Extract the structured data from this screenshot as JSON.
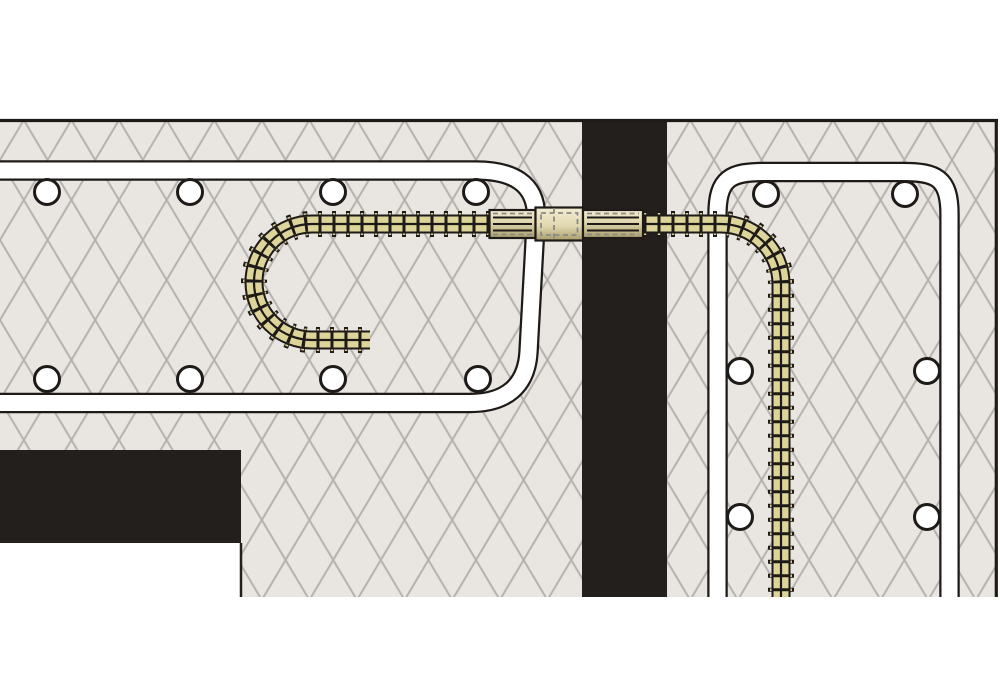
{
  "illustration": {
    "kind": "construction-detail-diagram",
    "shows": "hooked rebar joined to continuing rebar by a mechanical splice coupler passing through a dark joint band between hatched concrete sections, with stirrup outlines and rebar cross-section circles"
  },
  "colors": {
    "page_bg": "#ffffff",
    "concrete_bg": "#e9e6e1",
    "hatch_line": "#b6b3ae",
    "ink": "#1d1a18",
    "joint_fill": "#221f1c",
    "band_white": "#ffffff",
    "rebar_fill": "#ddd49a",
    "coupler_light": "#f2ecd2",
    "coupler_mid": "#e2d9b2",
    "coupler_dark": "#a99d6b",
    "dash_gray": "#8a8a85"
  },
  "counts": {
    "cross_section_circles_left": 8,
    "cross_section_circles_right": 6
  }
}
